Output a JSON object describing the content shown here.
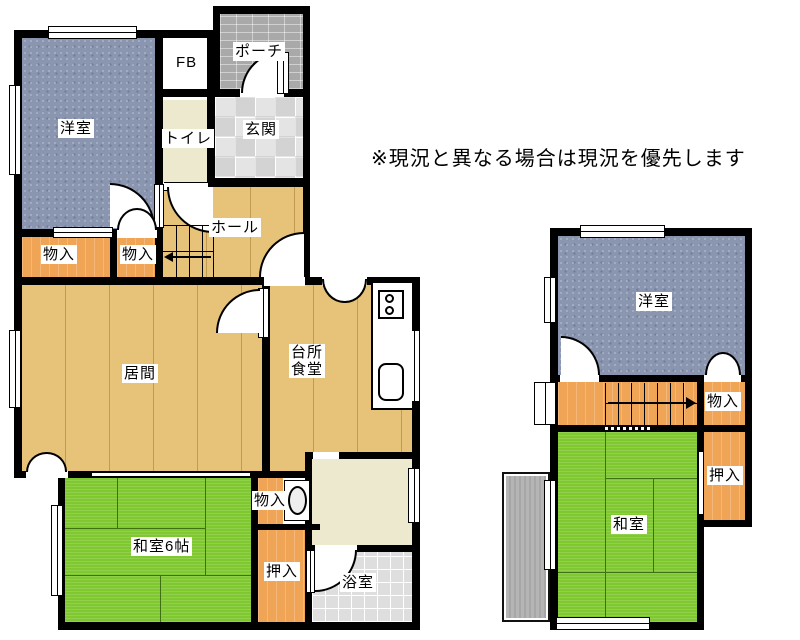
{
  "disclaimer": "※現況と異なる場合は現況を優先します",
  "floor1": {
    "rooms": {
      "youshitsu": "洋室",
      "fb": "FB",
      "porch": "ポーチ",
      "toilet": "トイレ",
      "genkan": "玄関",
      "hall": "ホール",
      "monoire_a": "物入",
      "monoire_b": "物入",
      "ima": "居間",
      "daidokoro1": "台所",
      "daidokoro2": "食堂",
      "washitsu": "和室6帖",
      "monoire_c": "物入",
      "oshiire": "押入",
      "bath": "浴室"
    },
    "stairs": {
      "direction": "left"
    }
  },
  "floor2": {
    "rooms": {
      "youshitsu": "洋室",
      "monoire": "物入",
      "oshiire": "押入",
      "washitsu": "和室"
    },
    "stairs": {
      "direction": "right"
    }
  },
  "colors": {
    "wall": "#000000",
    "western_room": "#8a95b0",
    "tatami_room": "#7fc82f",
    "closet": "#f0a455",
    "wood_floor": "#e7c279",
    "toilet_washroom": "#ece9cf",
    "entry_tile": "#e4e4e4",
    "porch_tile": "#a9a9a9",
    "bath_tile": "#dedede",
    "balcony": "#b5b5b5"
  }
}
